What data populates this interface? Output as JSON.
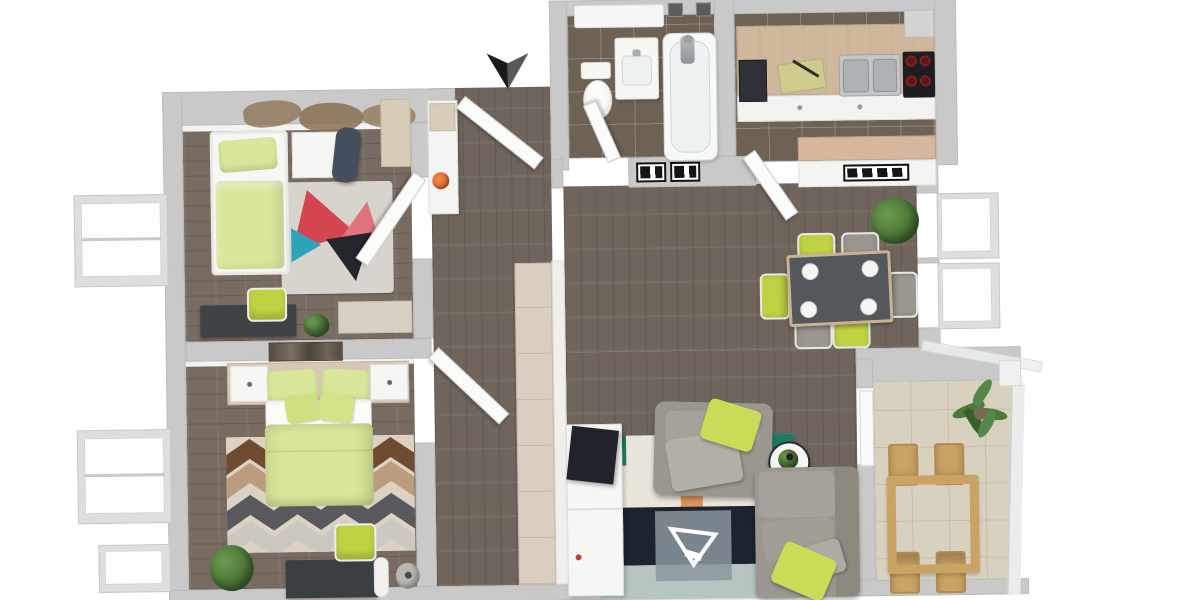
{
  "title": "3D apartment floor plan rendering, top-down view",
  "palette": {
    "wall_outer": "#c9c9c9",
    "floor_wood": "#6f655d",
    "floor_wood_dark": "#786b62",
    "tile_dark": "#6e6255",
    "balcony_tile": "#d8d1c0",
    "balcony_grout": "#c6bfae",
    "lime": "#bfd243",
    "lime_light": "#d9e79b",
    "sofa_gray": "#9b968f",
    "table_dark": "#54585d",
    "counter_wood": "#cfb79c",
    "closet_wood": "#d9cec0",
    "rug_teal": "#1f7a62",
    "rug_navy": "#1c2430",
    "rug_orange": "#dd8a50",
    "accent_orange": "#e0622a",
    "cooktop_black": "#1c1e21",
    "burner_red": "#c03028",
    "plant_green": "#4a7a38"
  },
  "entrance": {
    "marker": "black-arrow-down"
  },
  "rooms": [
    {
      "id": "bedroom-small",
      "furniture": [
        "single-bed",
        "nightstand",
        "lounger",
        "world-map-decal",
        "triangle-rug",
        "desk",
        "desk-chair",
        "plant",
        "dresser",
        "sideboard"
      ]
    },
    {
      "id": "bedroom-master",
      "furniture": [
        "double-bed",
        "headboard",
        "nightstand-left",
        "nightstand-right",
        "wall-art",
        "chevron-rug",
        "desk",
        "desk-chair",
        "paper-roll-lamp",
        "waste-bin",
        "plant"
      ]
    },
    {
      "id": "bathroom",
      "furniture": [
        "toilet",
        "vanity-sink",
        "bathtub",
        "shower-fixture",
        "mirror",
        "radiator",
        "radiator"
      ]
    },
    {
      "id": "kitchen",
      "furniture": [
        "countertop",
        "oven",
        "cutting-board",
        "double-sink",
        "cooktop",
        "hood",
        "base-cabinets",
        "peninsula-counter",
        "radiator"
      ]
    },
    {
      "id": "dining",
      "furniture": [
        "dining-table",
        "plates",
        "chair-lime",
        "chair-gray",
        "chair-lime",
        "chair-gray",
        "chair-gray",
        "chair-lime",
        "plant",
        "window",
        "window"
      ]
    },
    {
      "id": "living",
      "furniture": [
        "tv-sideboard",
        "tv",
        "patch-rug",
        "triangle-logo",
        "armchair",
        "lime-pillow",
        "round-side-table",
        "sofa",
        "lime-pillow"
      ]
    },
    {
      "id": "hallway",
      "furniture": [
        "console",
        "orange-bowl",
        "wardrobe-closet",
        "entrance-door",
        "interior-doors"
      ]
    },
    {
      "id": "balcony",
      "furniture": [
        "outdoor-table",
        "outdoor-chair",
        "outdoor-chair",
        "outdoor-chair",
        "outdoor-chair",
        "palm-plant",
        "glass-railing"
      ]
    }
  ]
}
